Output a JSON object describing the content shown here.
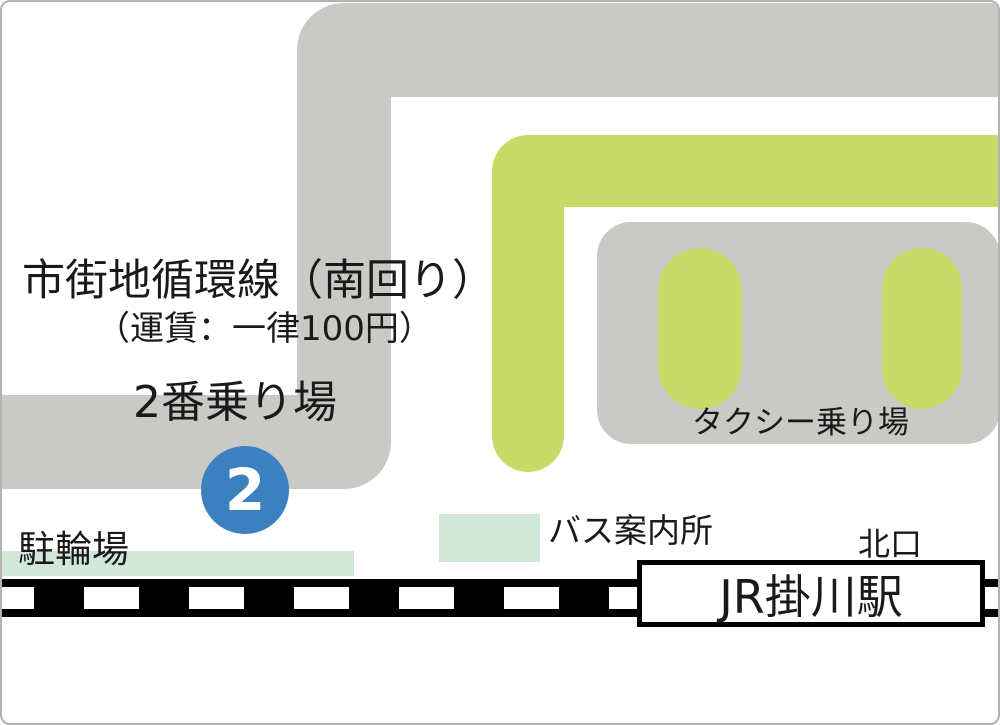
{
  "route": {
    "title": "市街地循環線（南回り）",
    "fare": "（運賃：一律100円）"
  },
  "stop": {
    "name": "2番乗り場",
    "badge_number": "2"
  },
  "labels": {
    "taxi": "タクシー乗り場",
    "bus_info": "バス案内所",
    "bicycle": "駐輪場",
    "north_exit": "北口",
    "station": "JR掛川駅"
  },
  "colors": {
    "road_gray": "#c9c9c6",
    "road_green": "#c8da68",
    "mint": "#d0e7d9",
    "badge_blue": "#3d80c0",
    "track_black": "#000000",
    "ink": "#1a1a1a",
    "border_gray": "#b3b3b3"
  }
}
